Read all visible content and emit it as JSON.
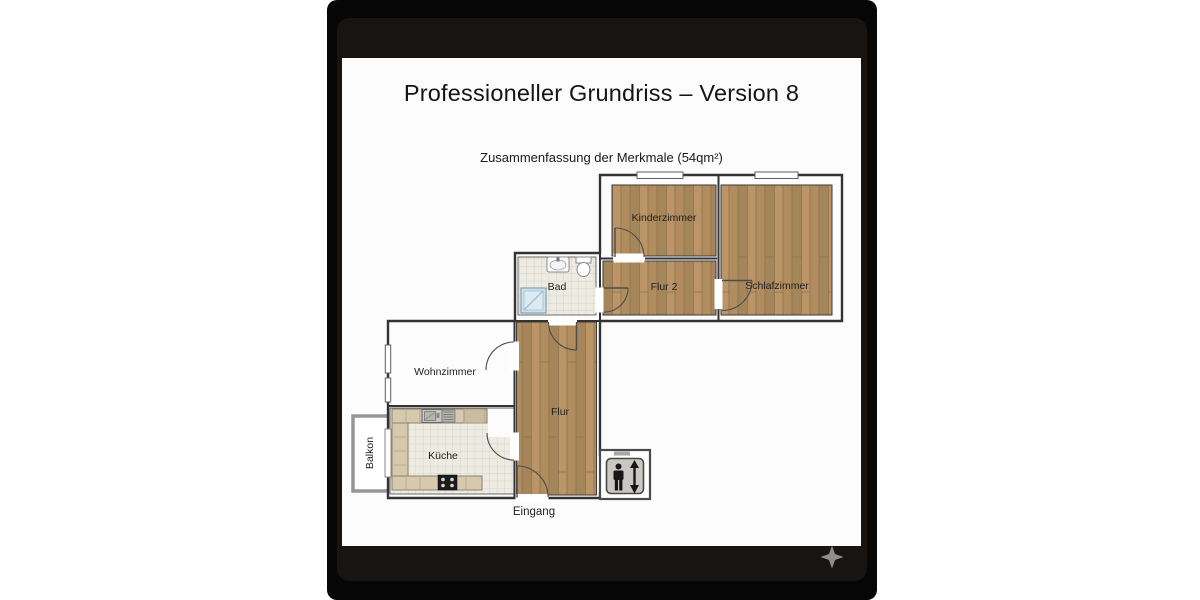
{
  "document": {
    "title": "Professioneller Grundriss – Version 8",
    "subtitle": "Zusammenfassung der Merkmale (54qm²)"
  },
  "floorplan": {
    "labels": {
      "kinderzimmer": "Kinderzimmer",
      "schlafzimmer": "Schlafzimmer",
      "flur2": "Flur 2",
      "bad": "Bad",
      "wohnzimmer": "Wohnzimmer",
      "kueche": "Küche",
      "flur": "Flur",
      "balkon": "Balkon",
      "eingang": "Eingang"
    },
    "area_total": "54qm²",
    "colors": {
      "wood_light": "#bb9468",
      "wood_mid": "#b08c5e",
      "wood_dark": "#a5855a",
      "plank_line": "#8e7349",
      "tile_base": "#edebe2",
      "tile_line": "#d6d3c8",
      "counter": "#d7caac",
      "counter_line": "#b3a78b",
      "shower": "#cfe0ea",
      "stove": "#1c1c1c",
      "wall": "#333333",
      "balcony_rail": "#979797",
      "elevator_panel": "#cbc8c3",
      "pictogram": "#161616"
    },
    "icons": {
      "sink": "washbasin",
      "toilet": "toilet",
      "shower": "shower",
      "stove": "stove-4-burners",
      "kitchen_sink": "kitchen-sink-with-drainer",
      "elevator": "elevator-person-up-down-arrows"
    }
  },
  "viewer": {
    "background": "#060606",
    "card": "#171412",
    "page": "#fcfcfc",
    "star_color": "#8f8f8f",
    "star_icon": "four-point-star"
  }
}
